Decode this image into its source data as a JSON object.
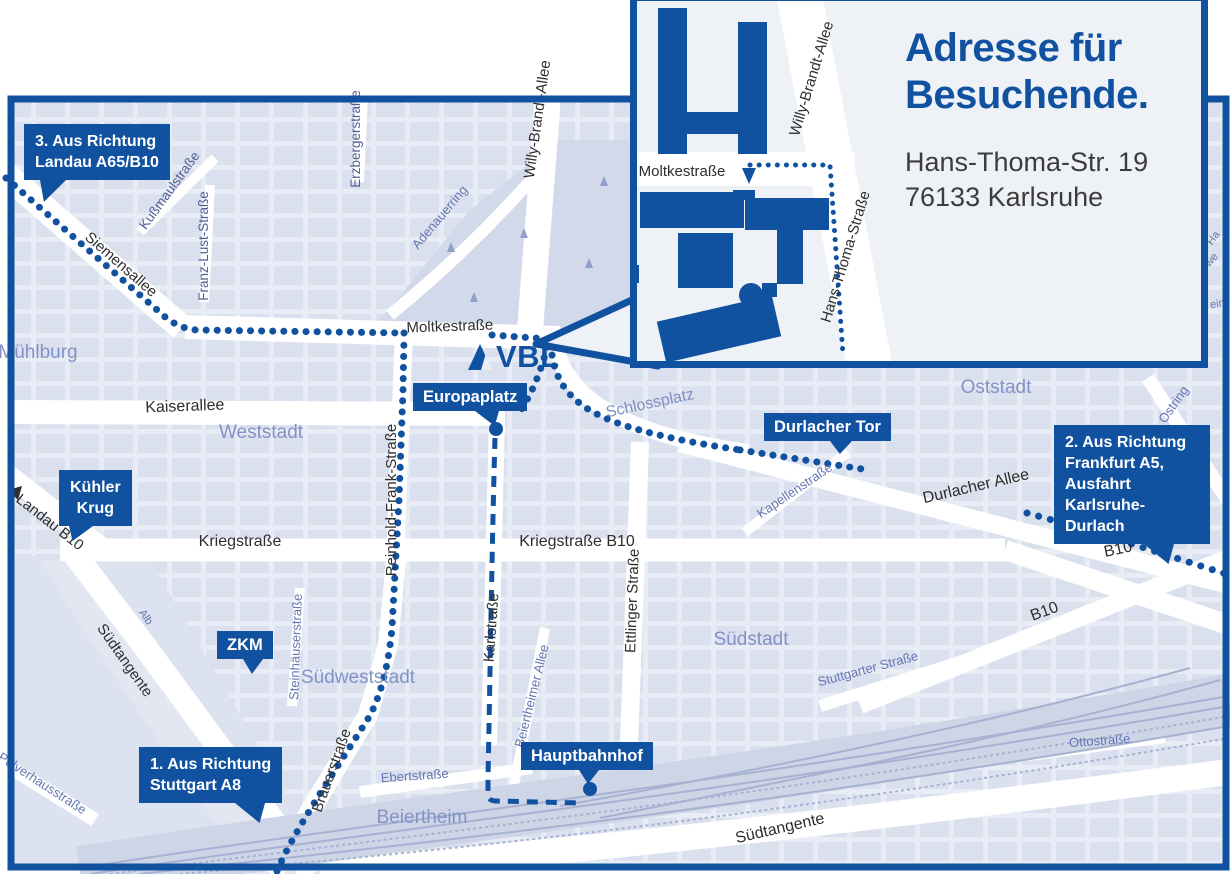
{
  "colors": {
    "brand_blue": "#1152a0",
    "map_background": "#e8ecf4",
    "city_block": "#dbe0ee",
    "district_label": "#8392c5",
    "minor_street_label": "#6376b1",
    "major_street_label": "#2e2e2e",
    "address_text": "#3c3c3b"
  },
  "logo": {
    "text": "VBL"
  },
  "inset": {
    "title": "Adresse für\nBesuchende.",
    "address": "Hans-Thoma-Str. 19\n76133 Karlsruhe",
    "streets": {
      "moltkestrasse": "Moltkestraße",
      "willy_brandt": "Willy-Brandt-Allee",
      "hans_thoma": "Hans-Thoma-Straße"
    }
  },
  "callouts": {
    "landau": {
      "text": "3. Aus Richtung\nLandau A65/B10"
    },
    "kuehler_krug": {
      "text": "Kühler\nKrug"
    },
    "zkm": {
      "text": "ZKM"
    },
    "stuttgart": {
      "text": "1. Aus Richtung\nStuttgart A8"
    },
    "europaplatz": {
      "text": "Europaplatz"
    },
    "durlacher_tor": {
      "text": "Durlacher Tor"
    },
    "hauptbahnhof": {
      "text": "Hauptbahnhof"
    },
    "frankfurt": {
      "text": "2. Aus Richtung\nFrankfurt A5,\nAusfahrt\nKarlsruhe-Durlach"
    }
  },
  "map_labels": {
    "streets_black": {
      "siemensallee": "Siemensallee",
      "moltkestrasse": "Moltkestraße",
      "kaiserallee": "Kaiserallee",
      "kriegstrasse": "Kriegstraße",
      "kriegstrasse_b10": "Kriegstraße B10",
      "karlstrasse": "Karlstraße",
      "ettlinger_strasse": "Ettlinger Straße",
      "willy_brandt_allee": "Willy-Brandt-Allee",
      "reinhold_frank": "Reinhold-Frank-Straße",
      "durlacher_allee": "Durlacher Allee",
      "b10_east": "B10",
      "b10_south": "B10",
      "landau_b10": "Landau B10",
      "suedtangente_west": "Südtangente",
      "suedtangente_sued": "Südtangente",
      "brauerstrasse": "Brauerstraße"
    },
    "streets_mid": {
      "kussmaulstrasse": "Kußmaulstraße",
      "franz_lust": "Franz-Lust-Straße",
      "erzbergerstrasse": "Erzbergerstraße"
    },
    "streets_blue": {
      "adenauerring": "Adenauerring",
      "kapellenstrasse": "Kapellenstraße",
      "ostring": "Ostring",
      "ostring2": "Ostring",
      "steinhaeuserstrasse": "Steinhäuserstraße",
      "alb": "Alb",
      "beiertheimer_allee": "Beiertheimer Allee",
      "stuttgarter_strasse": "Stuttgarter Straße",
      "ottostrasse": "Ottostraße",
      "pulverhausstrasse": "Pulverhausstraße",
      "ebertstrasse": "Ebertstraße"
    },
    "districts": {
      "muehlburg": "Mühlburg",
      "weststadt": "Weststadt",
      "oststadt": "Oststadt",
      "suedstadt": "Südstadt",
      "suedweststadt": "Südweststadt",
      "beiertheim": "Beiertheim",
      "schlossplatz": "Schlossplatz"
    },
    "fragments": {
      "f1": "Ha",
      "f2": "we",
      "f3": "ein"
    }
  }
}
